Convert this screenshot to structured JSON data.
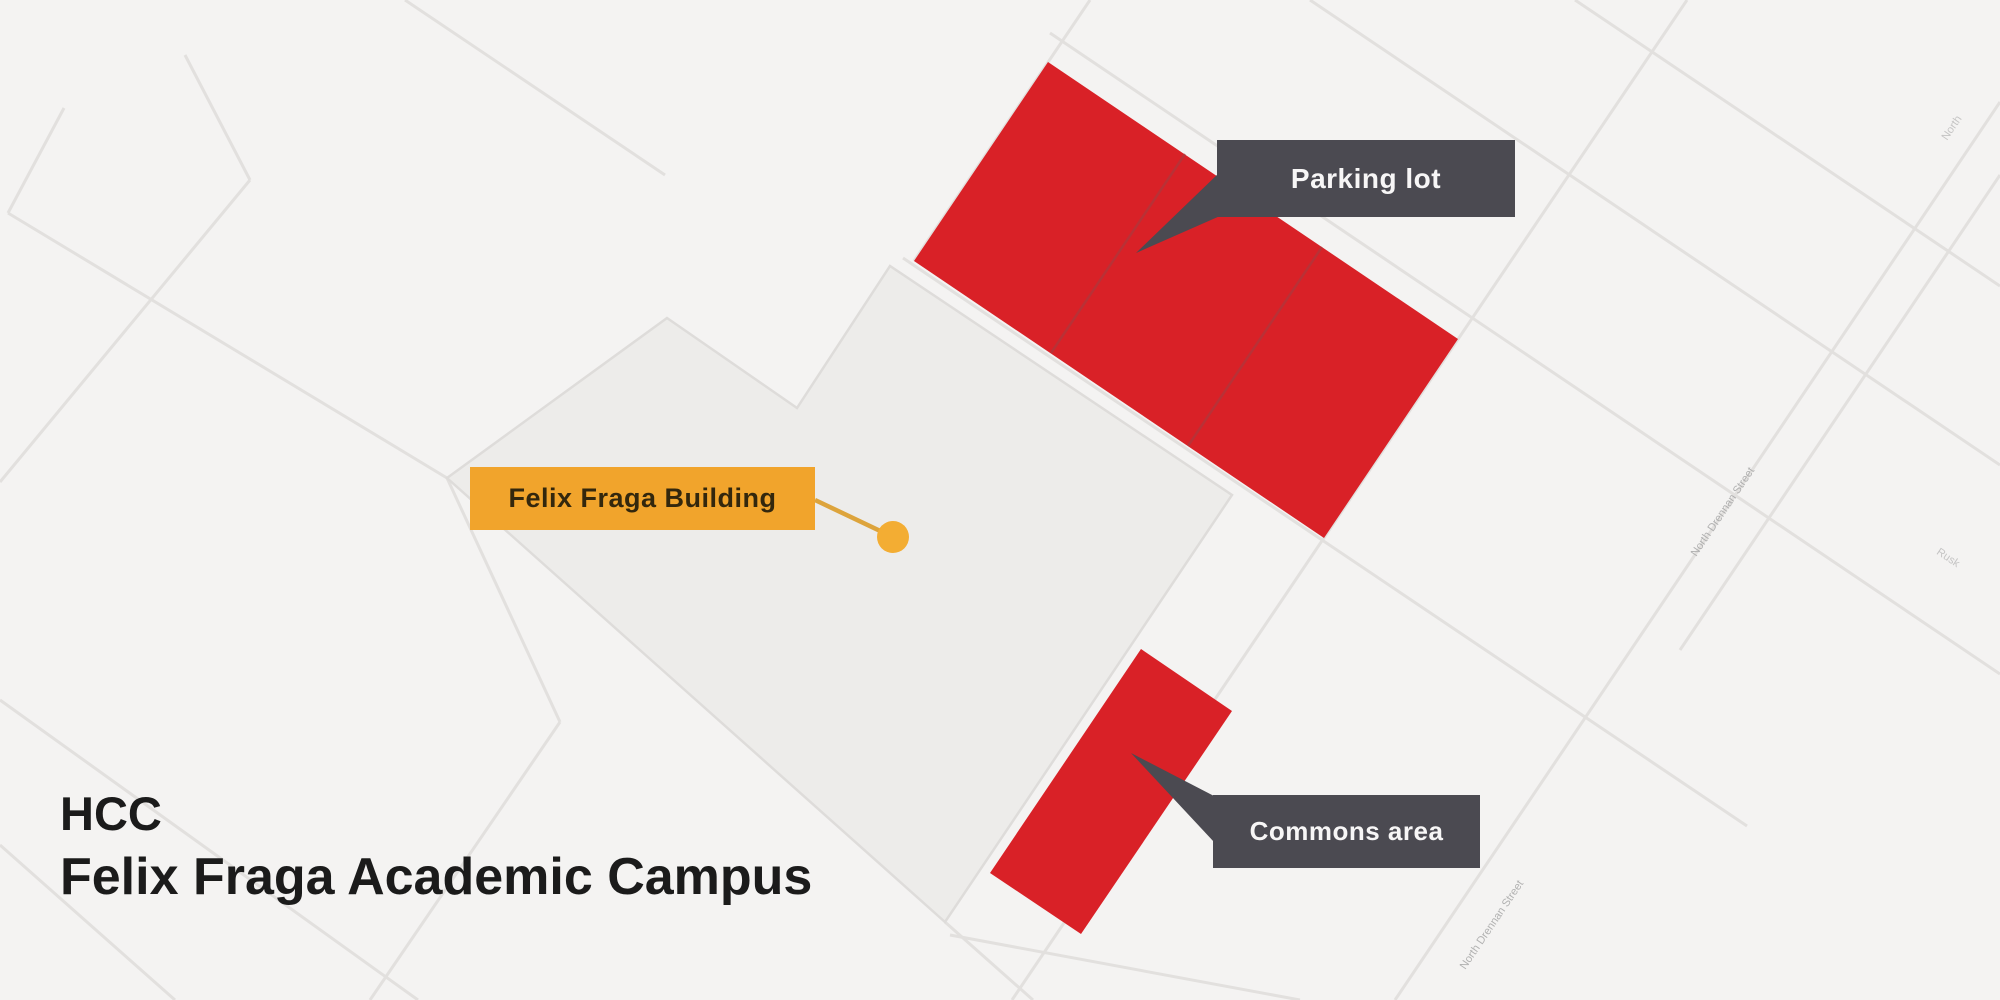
{
  "title": {
    "line1": "HCC",
    "line2": "Felix Fraga Academic Campus"
  },
  "callouts": {
    "building": {
      "text": "Felix Fraga Building"
    },
    "parking": {
      "text": "Parking lot"
    },
    "commons": {
      "text": "Commons area"
    }
  },
  "street_labels": [
    {
      "text": "North Drennan Street"
    },
    {
      "text": "North Drennan Street"
    },
    {
      "text": "North"
    },
    {
      "text": "Rusk"
    }
  ],
  "map": {
    "campus_name": "Felix Fraga Academic Campus",
    "highlighted_areas": [
      "Parking lot",
      "Commons area"
    ],
    "marked_building": "Felix Fraga Building",
    "colors": {
      "background": "#f4f3f2",
      "campus_parcel": "#edecea",
      "parcel_outline": "#dedcda",
      "highlight_red": "#d92127",
      "red_divider": "#9e3f44",
      "callout_dark": "#4b4a51",
      "callout_dark_text": "#f7f6f6",
      "callout_yellow": "#f1a42c",
      "callout_yellow_text": "#33270d",
      "connector_yellow": "#dda43c",
      "dot_yellow": "#f3ad33",
      "street_line": "#e2e0de",
      "street_text": "#a6a6a6",
      "title_text": "#1b1b1b"
    }
  }
}
